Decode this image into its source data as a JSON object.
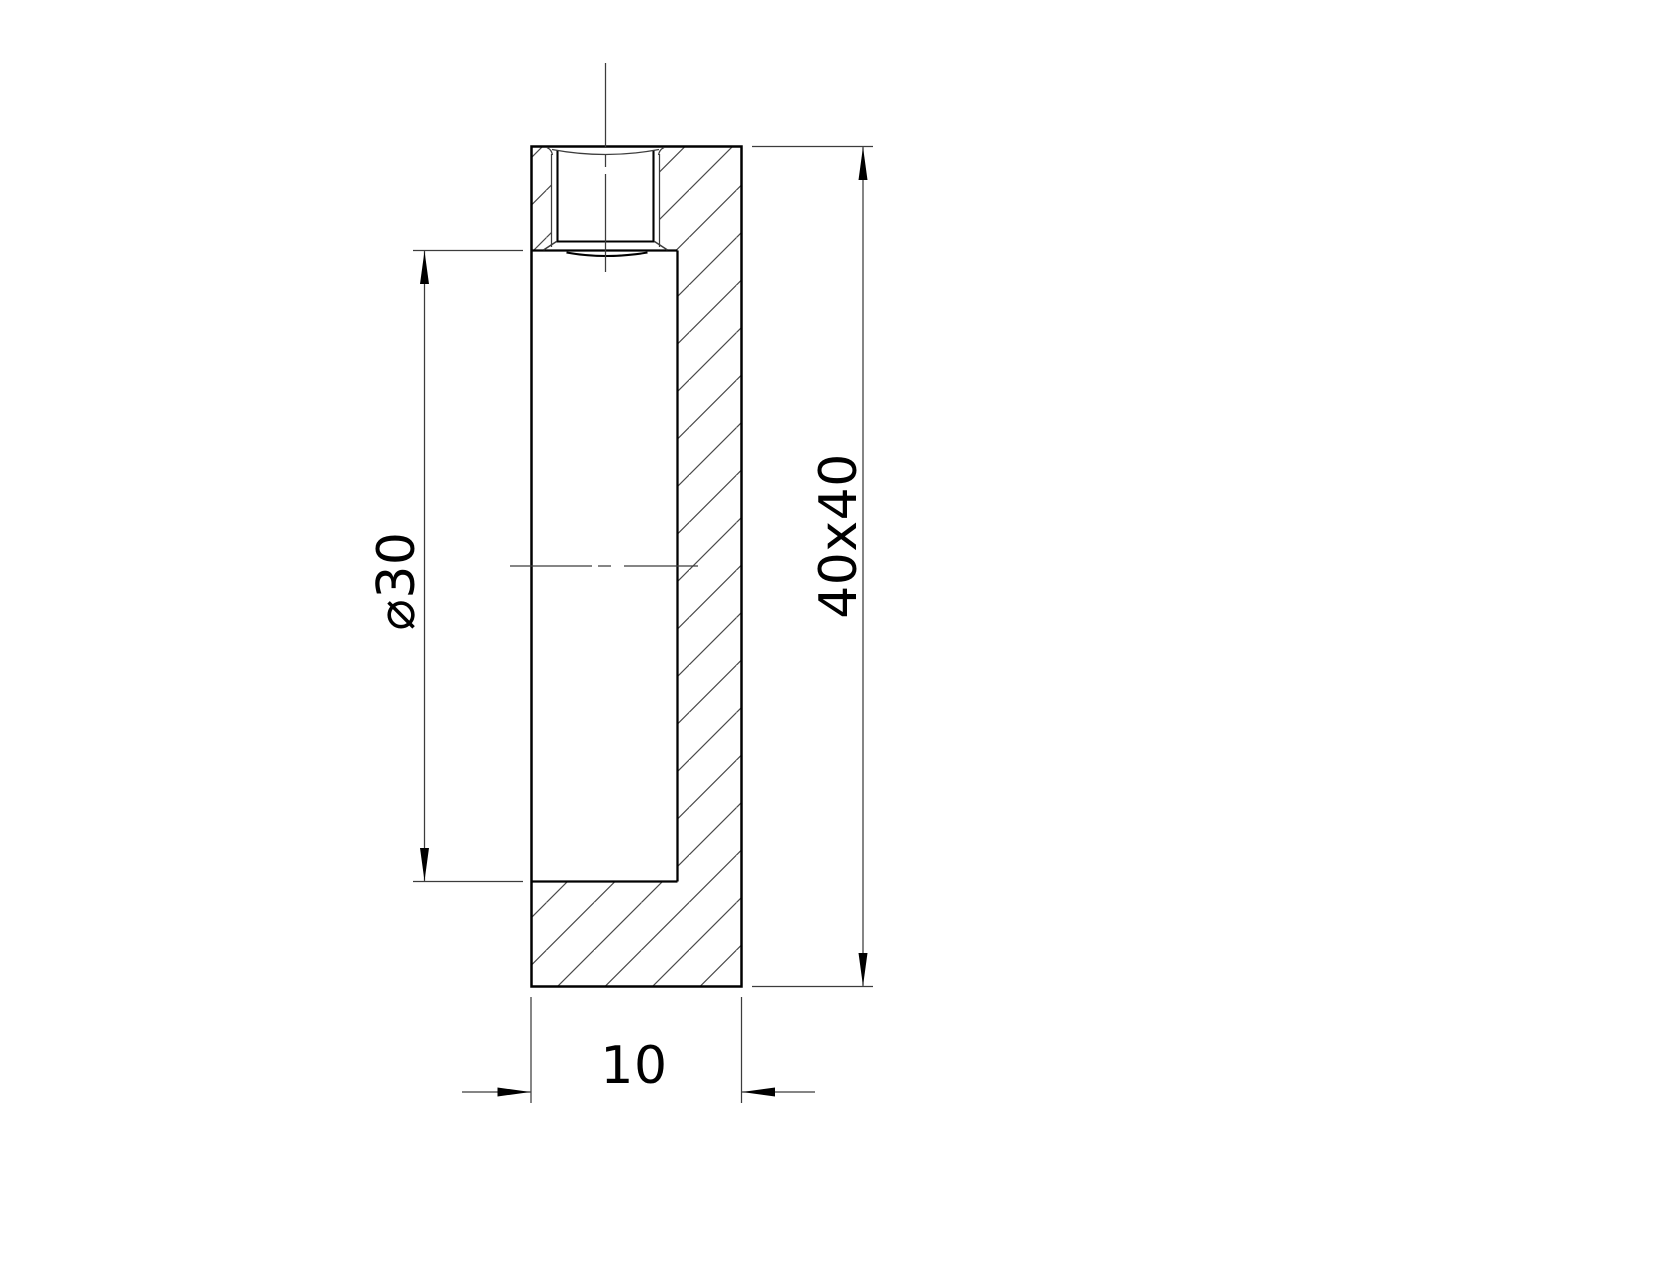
{
  "canvas": {
    "background": "#ffffff",
    "line_color": "#000000",
    "thin_line_color": "#3c3c3c",
    "hatch_line_color": "#4a4a4a"
  },
  "drawing": {
    "view": "section-view-of-block",
    "dimensions": {
      "bore_diameter_label": "⌀30",
      "profile_label": "40x40",
      "thickness_label": "10"
    }
  }
}
